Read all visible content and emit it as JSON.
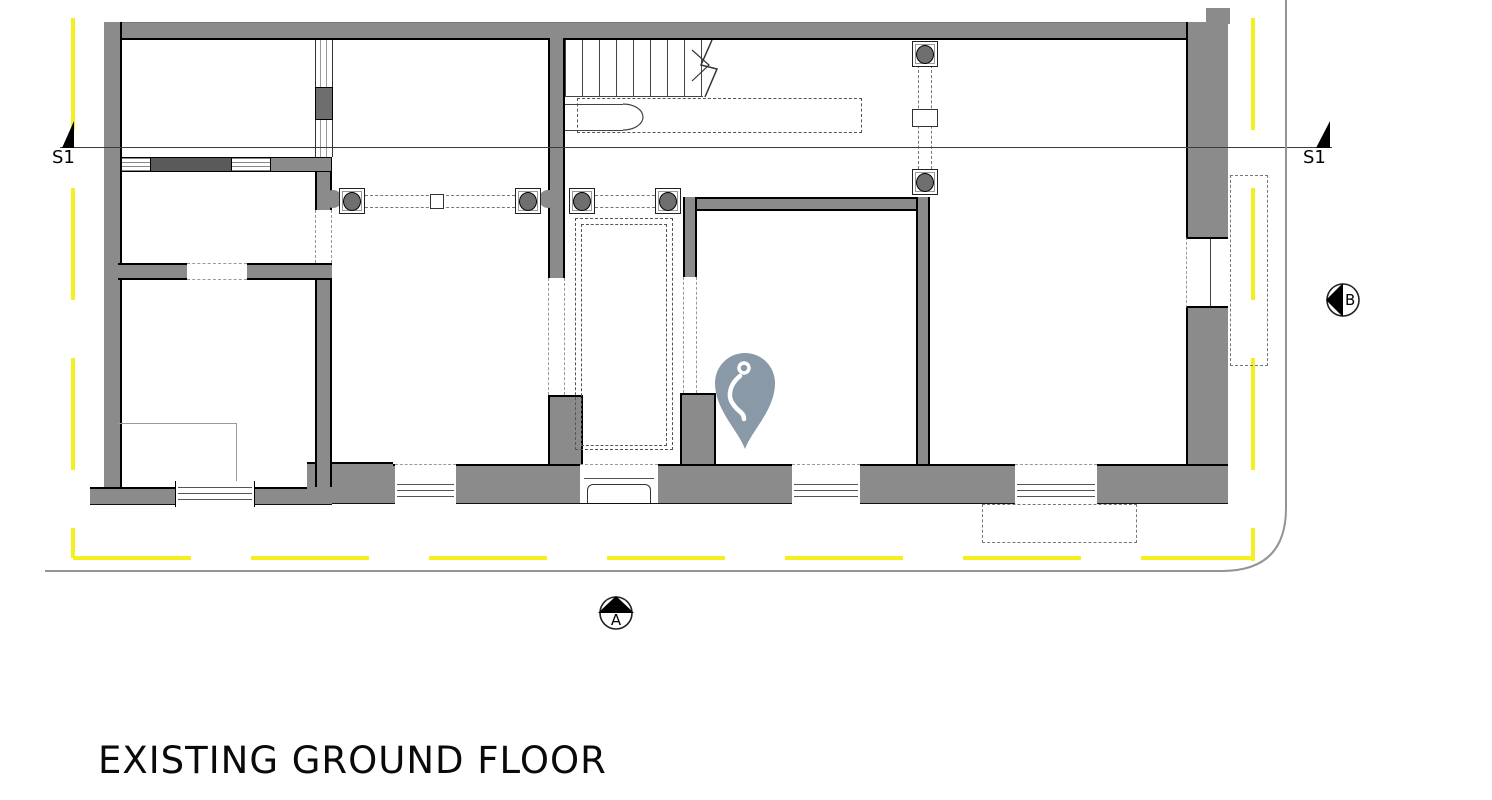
{
  "title": "EXISTING GROUND FLOOR",
  "markers": {
    "section_left": "S1",
    "section_right": "S1",
    "elevation_bottom": "A",
    "elevation_right": "B"
  },
  "icons": {
    "location_pin": "location-pin-icon",
    "section_cut_left": "section-cut-triangle-icon",
    "section_cut_right": "section-cut-triangle-icon",
    "elevation_a": "elevation-arrow-up-icon",
    "elevation_b": "elevation-arrow-left-icon"
  },
  "colors": {
    "wall_gray": "#8b8b8b",
    "wall_dark_pier": "#5a5a5a",
    "outline_black": "#000000",
    "boundary_yellow": "#f4ef1e",
    "street_line_gray": "#949494",
    "pin_blue_gray": "#8a99a8",
    "column_fill": "#6f6f6f"
  }
}
